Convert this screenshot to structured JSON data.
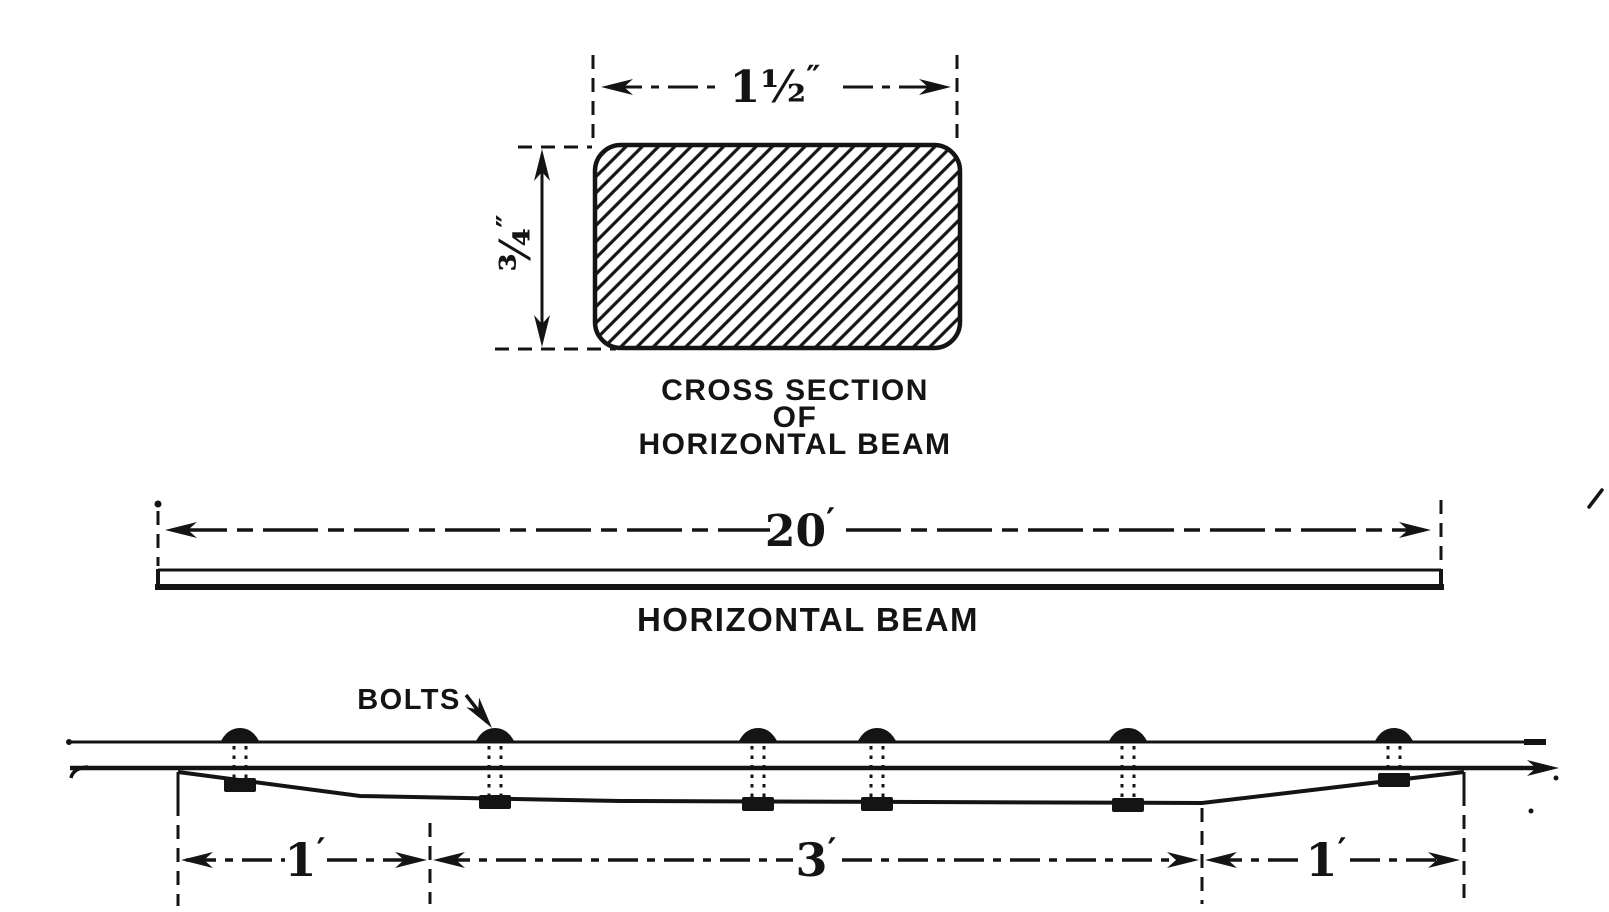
{
  "colors": {
    "ink": "#141414",
    "background": "#ffffff"
  },
  "cross_section_view": {
    "width_dim": {
      "value": "1½",
      "unit": "″"
    },
    "height_dim": {
      "value": "¾",
      "unit": "″"
    },
    "caption": {
      "line1": "CROSS SECTION",
      "line2": "OF",
      "line3": "HORIZONTAL BEAM"
    }
  },
  "beam_view": {
    "length_dim": {
      "value": "20",
      "unit": "′"
    },
    "caption": "HORIZONTAL BEAM"
  },
  "bolted_view": {
    "label_bolts": "BOLTS",
    "bolt_count": 6,
    "dims": [
      {
        "value": "1",
        "unit": "′"
      },
      {
        "value": "3",
        "unit": "′"
      },
      {
        "value": "1",
        "unit": "′"
      }
    ]
  }
}
